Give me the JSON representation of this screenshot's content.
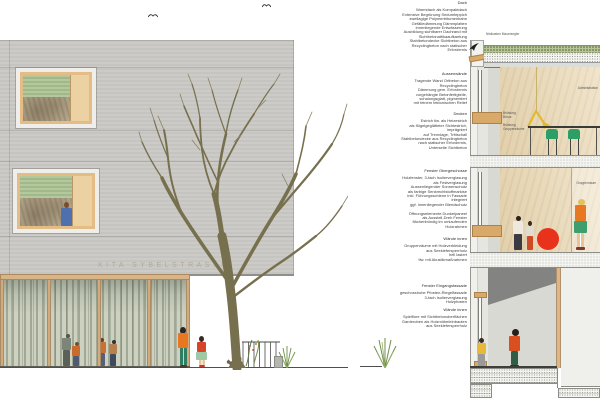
{
  "annotations": {
    "blocks": [
      {
        "heading": "Dach",
        "body": "Warmdach als Kompaktdach\nExtensive Begrünung Sedumteppich\nzweilagige Polymerbitumenbahn\nGefälledämmung Dämmplatten\ninnenliegende Entwässerung\nAusbildung sichtbarer Dachrand mit\nSichtbetonattikaaufkantung\nStahlbetondecke Sichtbeton aus\nRecyclingbeton nach statischer\nErfordernis"
      },
      {
        "heading": "Aussenwände",
        "body": "Tragende Wand Ortbeton aus\nRecyclingbeton\nDämmung gem. Erfordernis\nvorgehängte Betonfertigteile,\nschalungsglatt, pigmentiert\nmit feinem tektonischen Relief"
      },
      {
        "heading": "Decken",
        "body": "Estrich tlw. als Heizestrich\nals flügelgeglätteter Sichtestrich,\nimprägniert\nauf Trennlage, Trittschall\nStahlbetondecke aus Recyclingbeton\nnach statischer Erfordernis,\nUnterseite Sichtbeton"
      },
      {
        "heading": "Fenster Obergeschosse",
        "body": "Holzfenster, 3-fach Isolierverglasung\nals Festverglasung\nAussenliegender Sonnenschutz\nals farbige Senkrechtstoffmarkise\ninkl. Führungsschiene in Fassade\nintegriert\nggf. innenliegender Blendschutz\n\nÖffnungselemente Dunkelpaneel\nals Ausstell-Dreh Fenster\nflächenbündig im umlaufenden\nHolzrahmen"
      },
      {
        "heading": "Wände innen",
        "body": "Gruppenräume mit Holzverkleidung\naus Seekiefersperrholz\nhell lasiert\ntlw. mit Akustikmaßnahmen"
      },
      {
        "heading": "Fenster Eingangsfassade",
        "body": "geschosshohe Pfosten-Riegelfassade\n3-fach Isolierverglasung\nHolzpfosten"
      },
      {
        "heading": "Wände innen",
        "body": "Spielflure mit Sichtbetonoberflächen\nGarderoben als Holzmöbeleinbauten\naus Seekiefersperrholz"
      }
    ]
  },
  "elevation": {
    "signage": "KITA SYBELSTRASSE"
  },
  "section": {
    "nest_box_label": "Nistkasten Mauersegler",
    "parapet_offices": "Brüstung\nBüros",
    "parapet_groups": "Brüstung\nGruppenräume",
    "room_upper": "Administration",
    "room_middle": "Gruppenraum"
  },
  "colors": {
    "facade_grey": "#c9c8c4",
    "wood_frame": "#e3bd85",
    "blind_green": "#a9c08f",
    "chair_green": "#2d9e66",
    "ball_red": "#e8321c",
    "figure_orange": "#e87722",
    "plywood": "#ead9b6"
  }
}
